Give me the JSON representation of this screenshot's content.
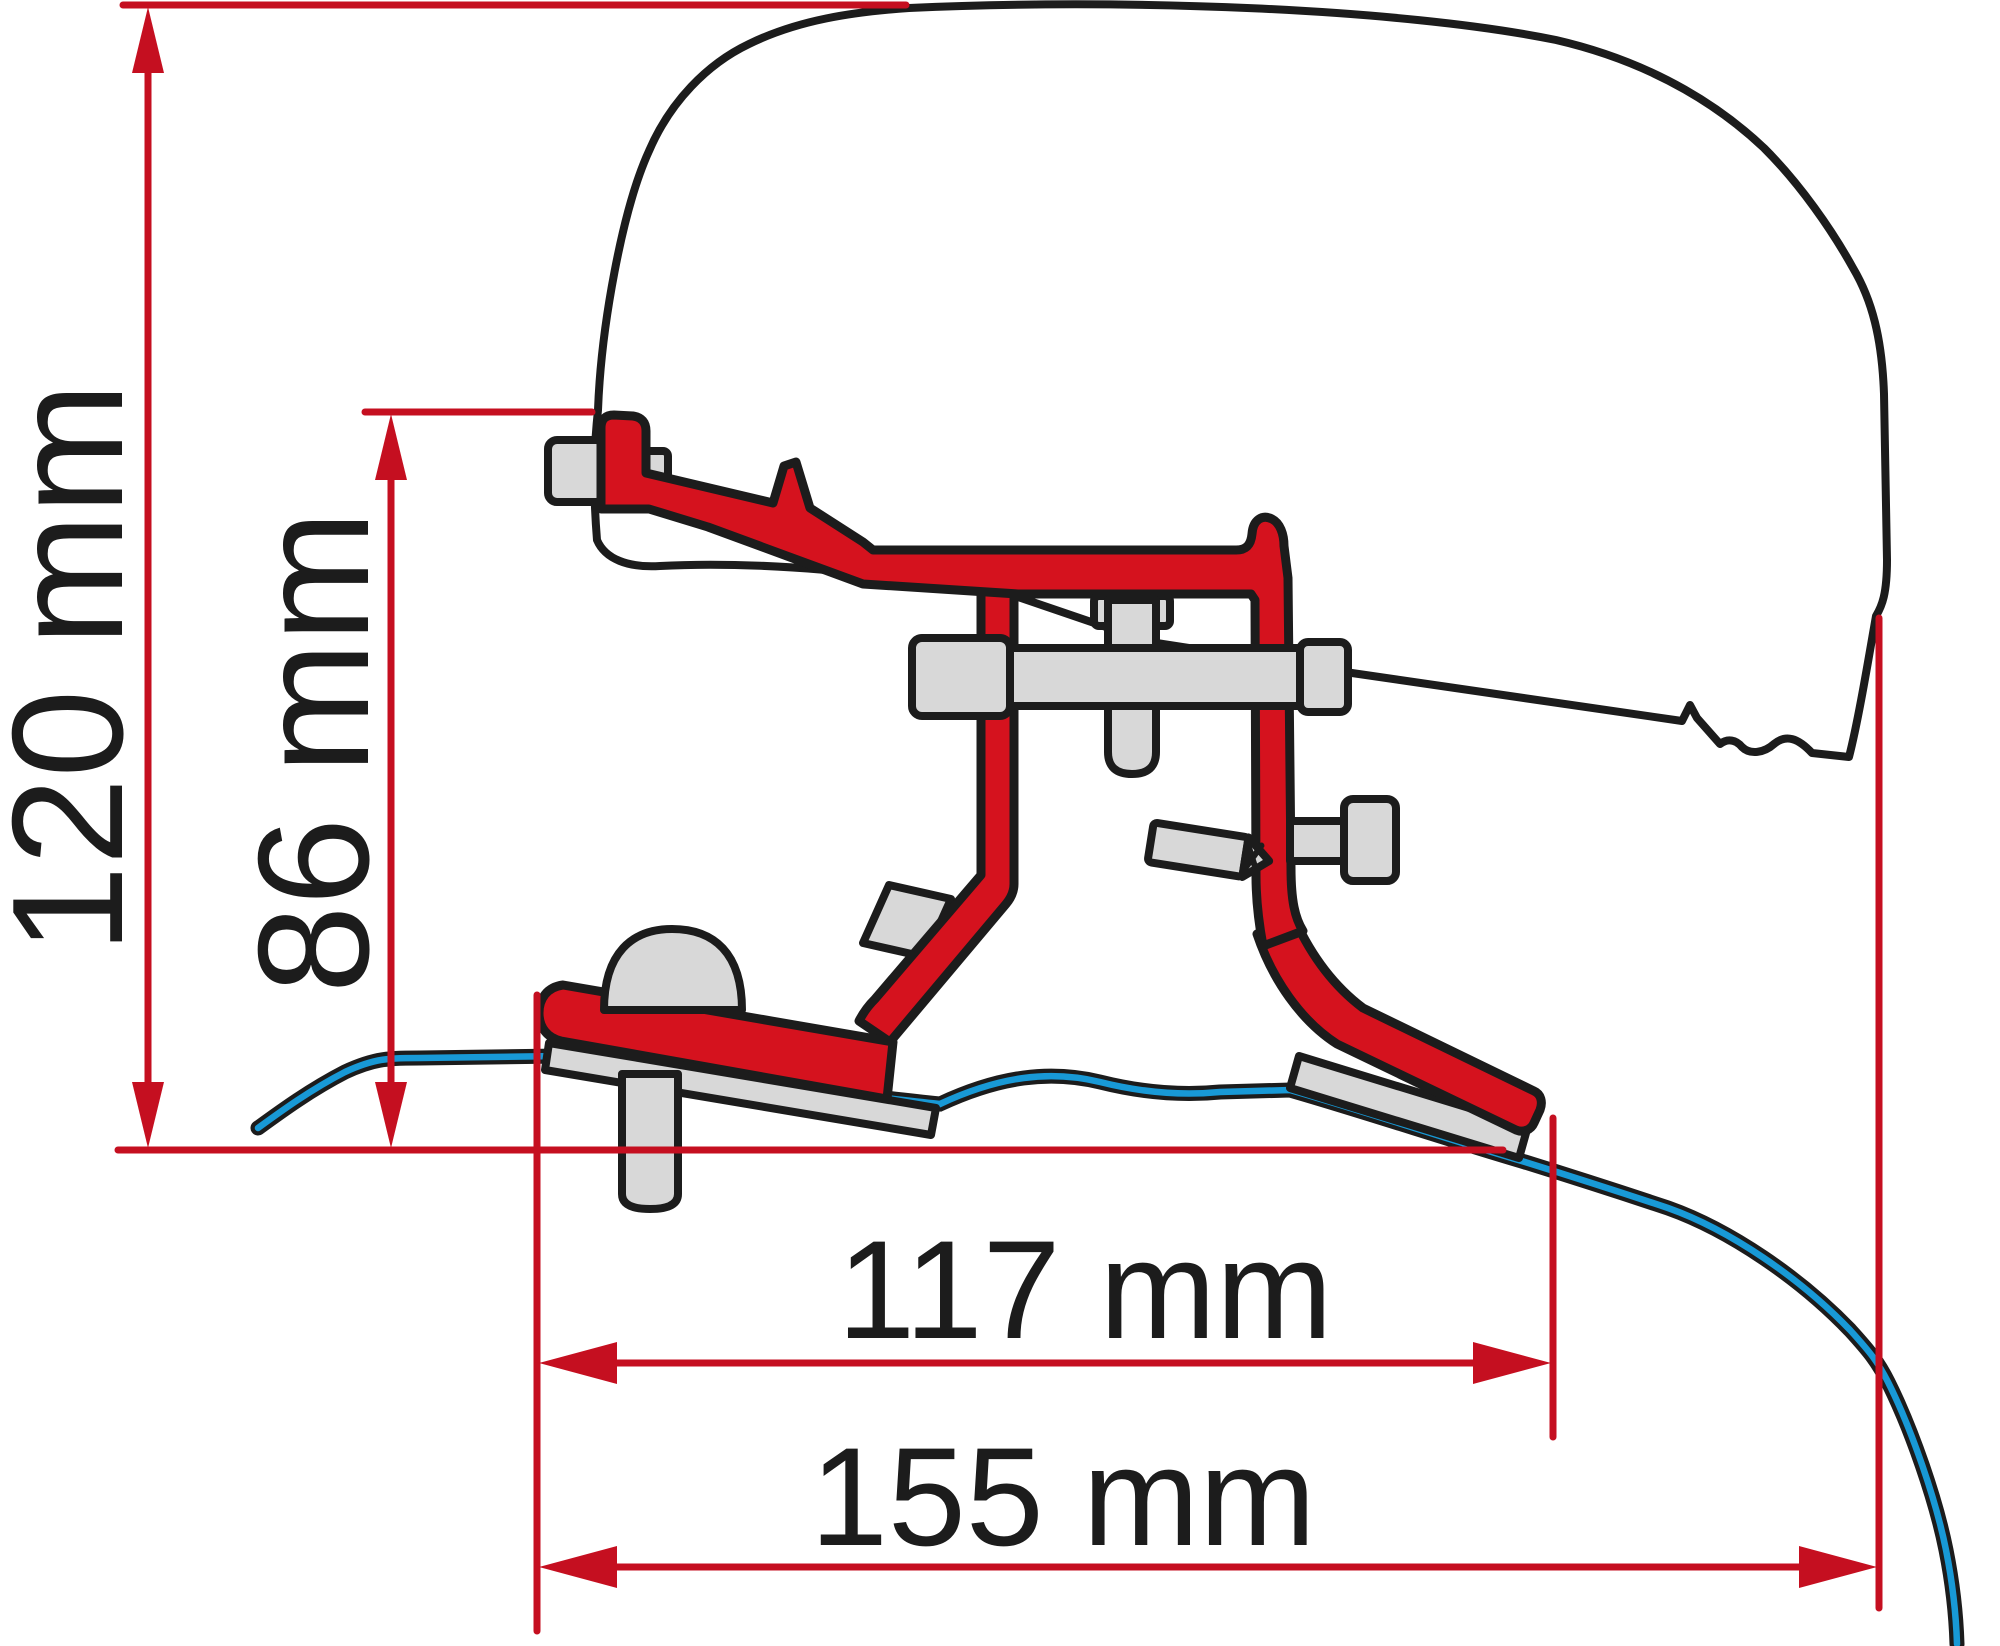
{
  "diagram": {
    "type": "technical-mounting-diagram",
    "dimension_labels": {
      "overall_height": "120 mm",
      "bracket_height": "86 mm",
      "inner_width": "117 mm",
      "overall_width": "155 mm"
    },
    "colors": {
      "red": "#d5121e",
      "dim": "#c50f20",
      "blue": "#1899d6",
      "gray": "#d8d8d8",
      "outline": "#1c1c1c",
      "bg": "#ffffff"
    }
  }
}
